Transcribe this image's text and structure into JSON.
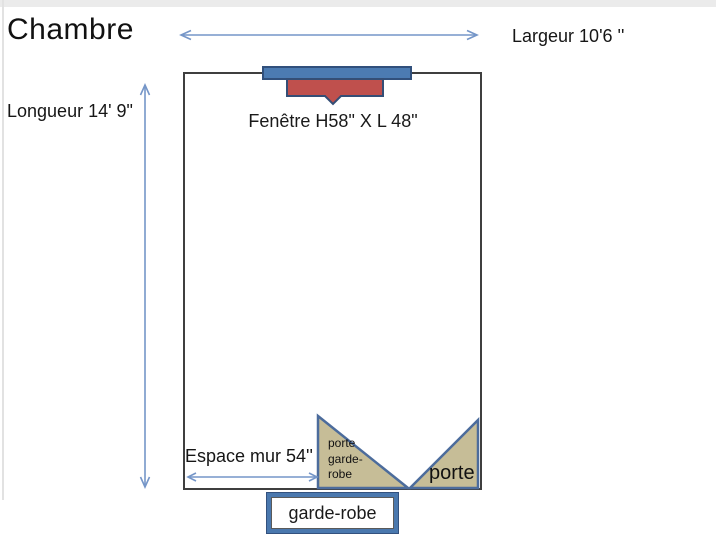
{
  "title": "Chambre",
  "room": {
    "width_label": "Largeur 10'6 ''",
    "length_label": "Longueur 14' 9\"",
    "wall_space_label": "Espace mur 54''"
  },
  "window": {
    "label": "Fenêtre H58\" X L 48\""
  },
  "doors": {
    "closet_door_label": "porte\ngarde-\nrobe",
    "entry_door_label": "porte"
  },
  "closet": {
    "label": "garde-robe"
  },
  "colors": {
    "wall": "#3f3f3f",
    "window_sill_fill": "#4c7bb2",
    "window_sill_border": "#31507c",
    "window_fill": "#bf504d",
    "window_border": "#344e76",
    "door_fill": "#c6bd97",
    "door_border": "#4c6c9c",
    "dimension_arrow": "#7596c8",
    "closet_box_border": "#4a78ae"
  }
}
